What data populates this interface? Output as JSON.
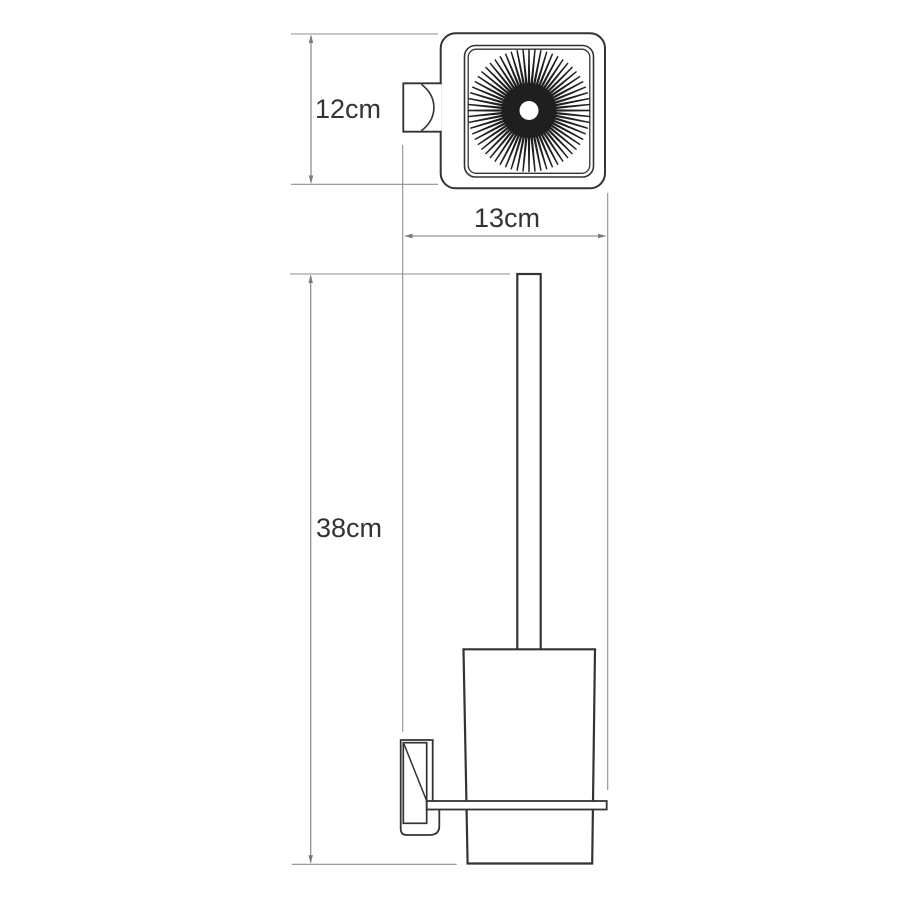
{
  "drawing": {
    "dimensions": {
      "top_height": {
        "label": "12cm"
      },
      "top_width": {
        "label": "13cm"
      },
      "front_height": {
        "label": "38cm"
      }
    },
    "colors": {
      "background": "#ffffff",
      "object_outline": "#333333",
      "bristles": "#1f1f1f",
      "dimension_line": "#7a7a7a",
      "extension_line": "#8f8f8f",
      "label_text": "#333333"
    }
  }
}
